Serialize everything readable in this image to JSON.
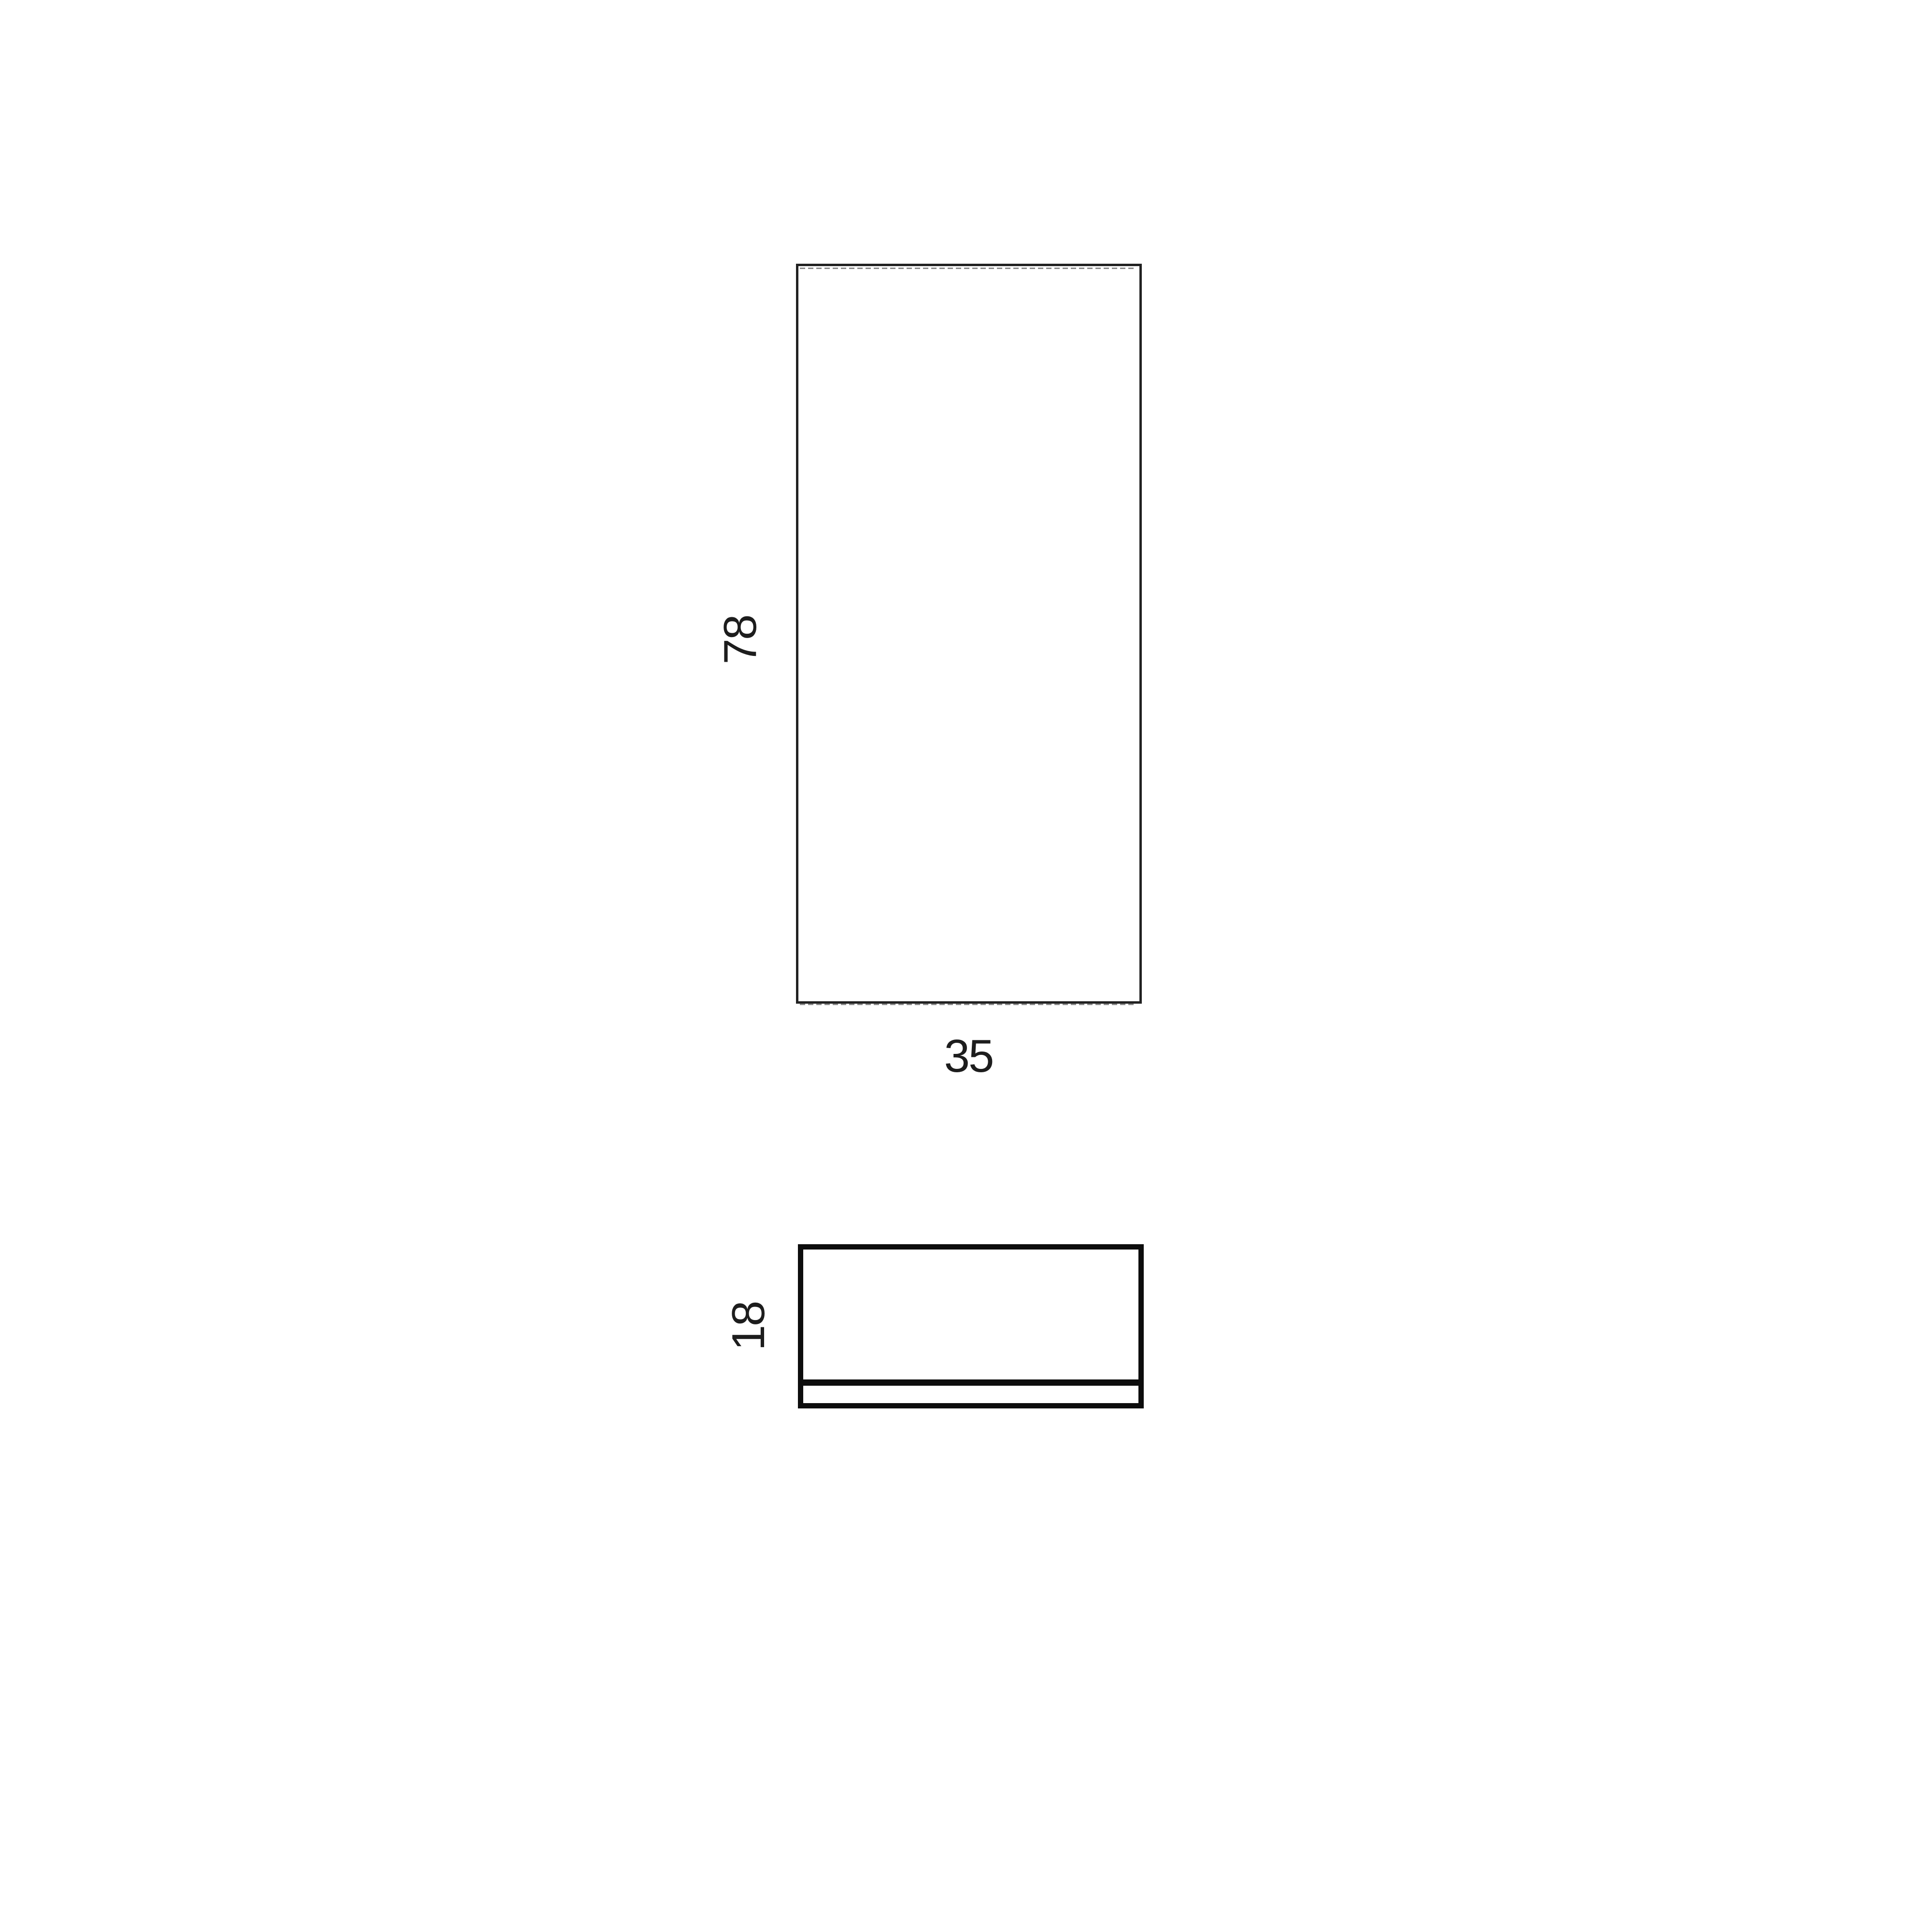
{
  "diagram": {
    "type": "furniture-dimension-drawing",
    "views": {
      "front": {
        "width_label": "35",
        "height_label": "78"
      },
      "side": {
        "depth_label": "18"
      }
    }
  },
  "colors": {
    "line": "#222222",
    "line-heavy": "#0d0d0d",
    "dash": "#8c8c8c",
    "text": "#1d1d1d",
    "bg": "#ffffff"
  }
}
